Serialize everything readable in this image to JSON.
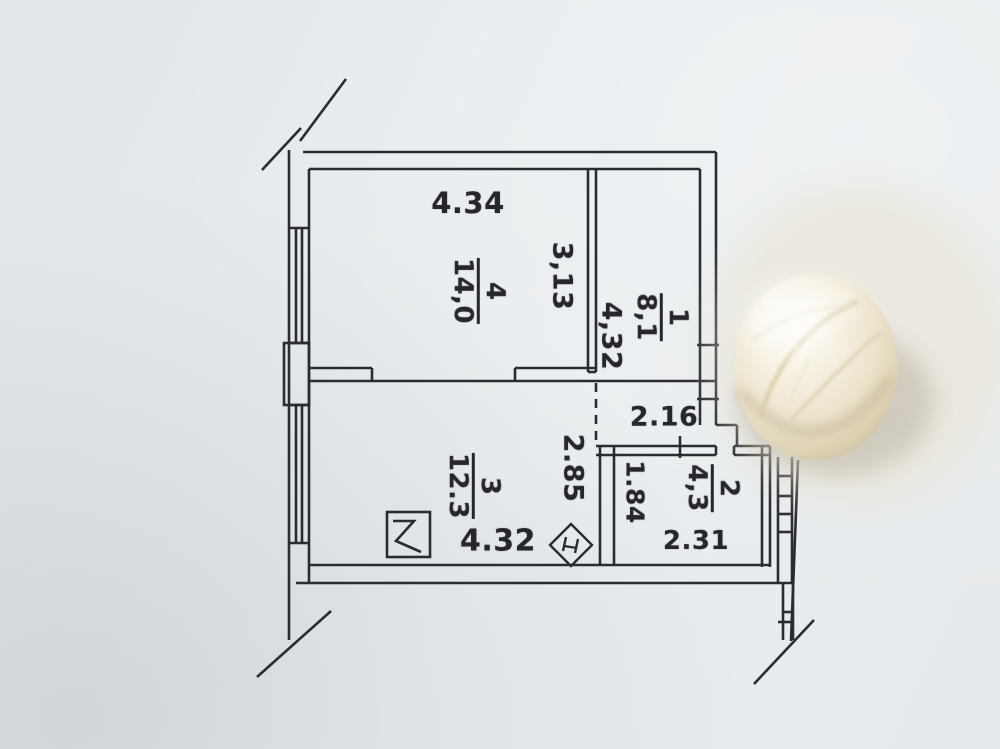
{
  "colors": {
    "paper": "#e7eaec",
    "ink": "#2b2b33",
    "dome_light": "#fcfbf6",
    "dome_mid": "#ece3cc",
    "dome_shadow": "#c8bda0"
  },
  "rooms": {
    "r1": {
      "number": "1",
      "area": "8,1"
    },
    "r2": {
      "number": "2",
      "area": "4,3"
    },
    "r3": {
      "number": "3",
      "area": "12.3"
    },
    "r4": {
      "number": "4",
      "area": "14,0"
    }
  },
  "dims": {
    "room4_width": "4.34",
    "room4_depth": "3,13",
    "hall_depth": "4,32",
    "hall_width": "2.16",
    "room3_depth": "2.85",
    "room3_width": "4.32",
    "room2_depth": "1.84",
    "room2_width": "2.31"
  },
  "symbols": {
    "vent_shaft": "ventilation-shaft-symbol",
    "marker": "diamond-marker-symbol"
  },
  "objects": {
    "dome": "white-shell-object"
  }
}
